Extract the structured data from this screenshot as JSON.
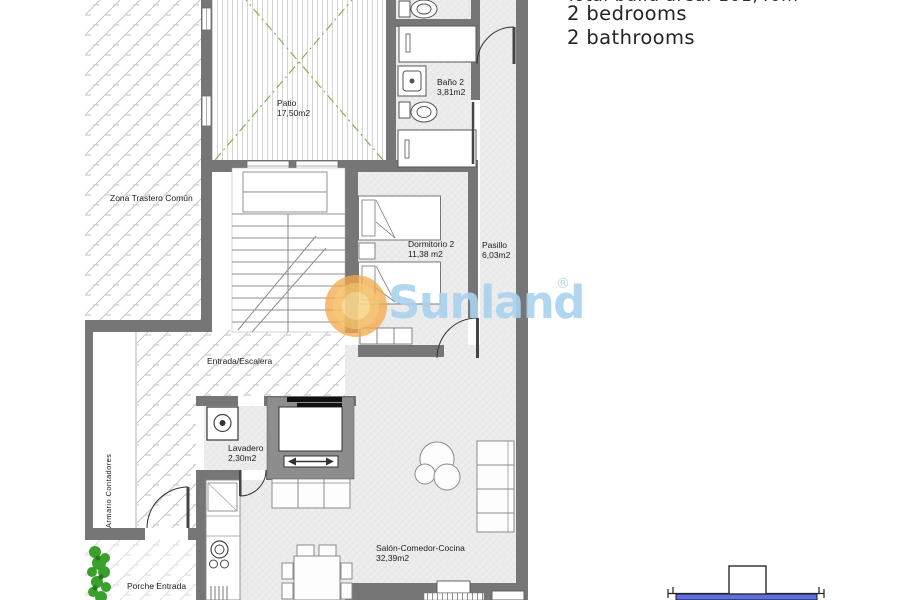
{
  "header": {
    "area_line_partial": "Total build area: 101,40m",
    "bedrooms": "2 bedrooms",
    "bathrooms": "2 bathrooms"
  },
  "watermark": {
    "brand": "Sunland",
    "registered_mark": "®"
  },
  "floorplan": {
    "rooms": {
      "zona_trastero": {
        "label": "Zona Trastero Común"
      },
      "patio": {
        "label": "Patio",
        "area": "17,50m2"
      },
      "bano2": {
        "label": "Baño 2",
        "area": "3,81m2"
      },
      "dormitorio2": {
        "label": "Dormitorio 2",
        "area": "11,38 m2"
      },
      "pasillo": {
        "label": "Pasillo",
        "area": "6,03m2"
      },
      "entrada": {
        "label": "Entrada/Escalera"
      },
      "armario": {
        "label": "Armario Contadores"
      },
      "lavadero": {
        "label": "Lavadero",
        "area": "2,30m2"
      },
      "salon": {
        "label": "Salón-Comedor-Cocina",
        "area": "32,39m2"
      },
      "porche": {
        "label": "Porche Entrada"
      }
    }
  },
  "colors": {
    "wall": "#767676",
    "hatch_line": "#c6c6c6",
    "floor_base": "#ededed",
    "patio_cross_green": "#86b44c",
    "watermark_blue": "#a9d2ee",
    "watermark_orange": "#f3a94e",
    "plant_green": "#39a02b",
    "site_band_blue": "#5f6fe2"
  }
}
